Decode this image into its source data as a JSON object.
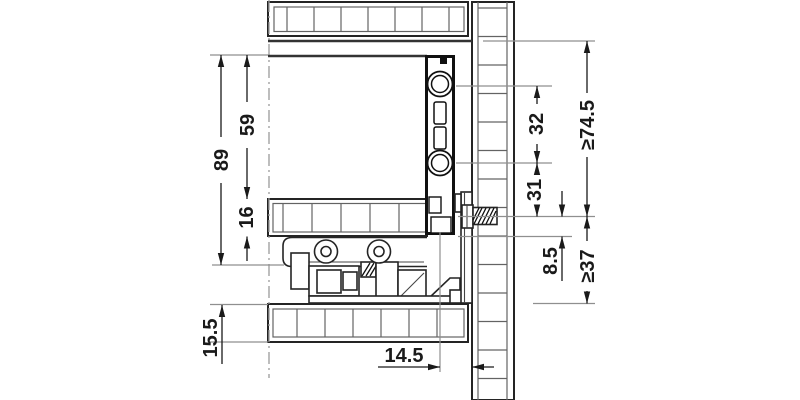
{
  "drawing": {
    "type": "technical-drawing-cross-section",
    "units": "mm",
    "background": "#ffffff",
    "colors": {
      "main_line": "#1a1a1a",
      "panel_outline": "#242424",
      "tile_line": "#636363",
      "reference_line": "#8f8f8f"
    },
    "dimensions": {
      "side_height": "89",
      "inner_height": "59",
      "bottom_panel_thickness": "16",
      "shelf_offset": "15.5",
      "rear_panel_gap": "14.5",
      "boss_spacing": "32",
      "boss_to_screw": "31",
      "screw_to_bottom": "8.5",
      "min_height_upper": "≥74.5",
      "min_height_lower": "≥37"
    }
  }
}
